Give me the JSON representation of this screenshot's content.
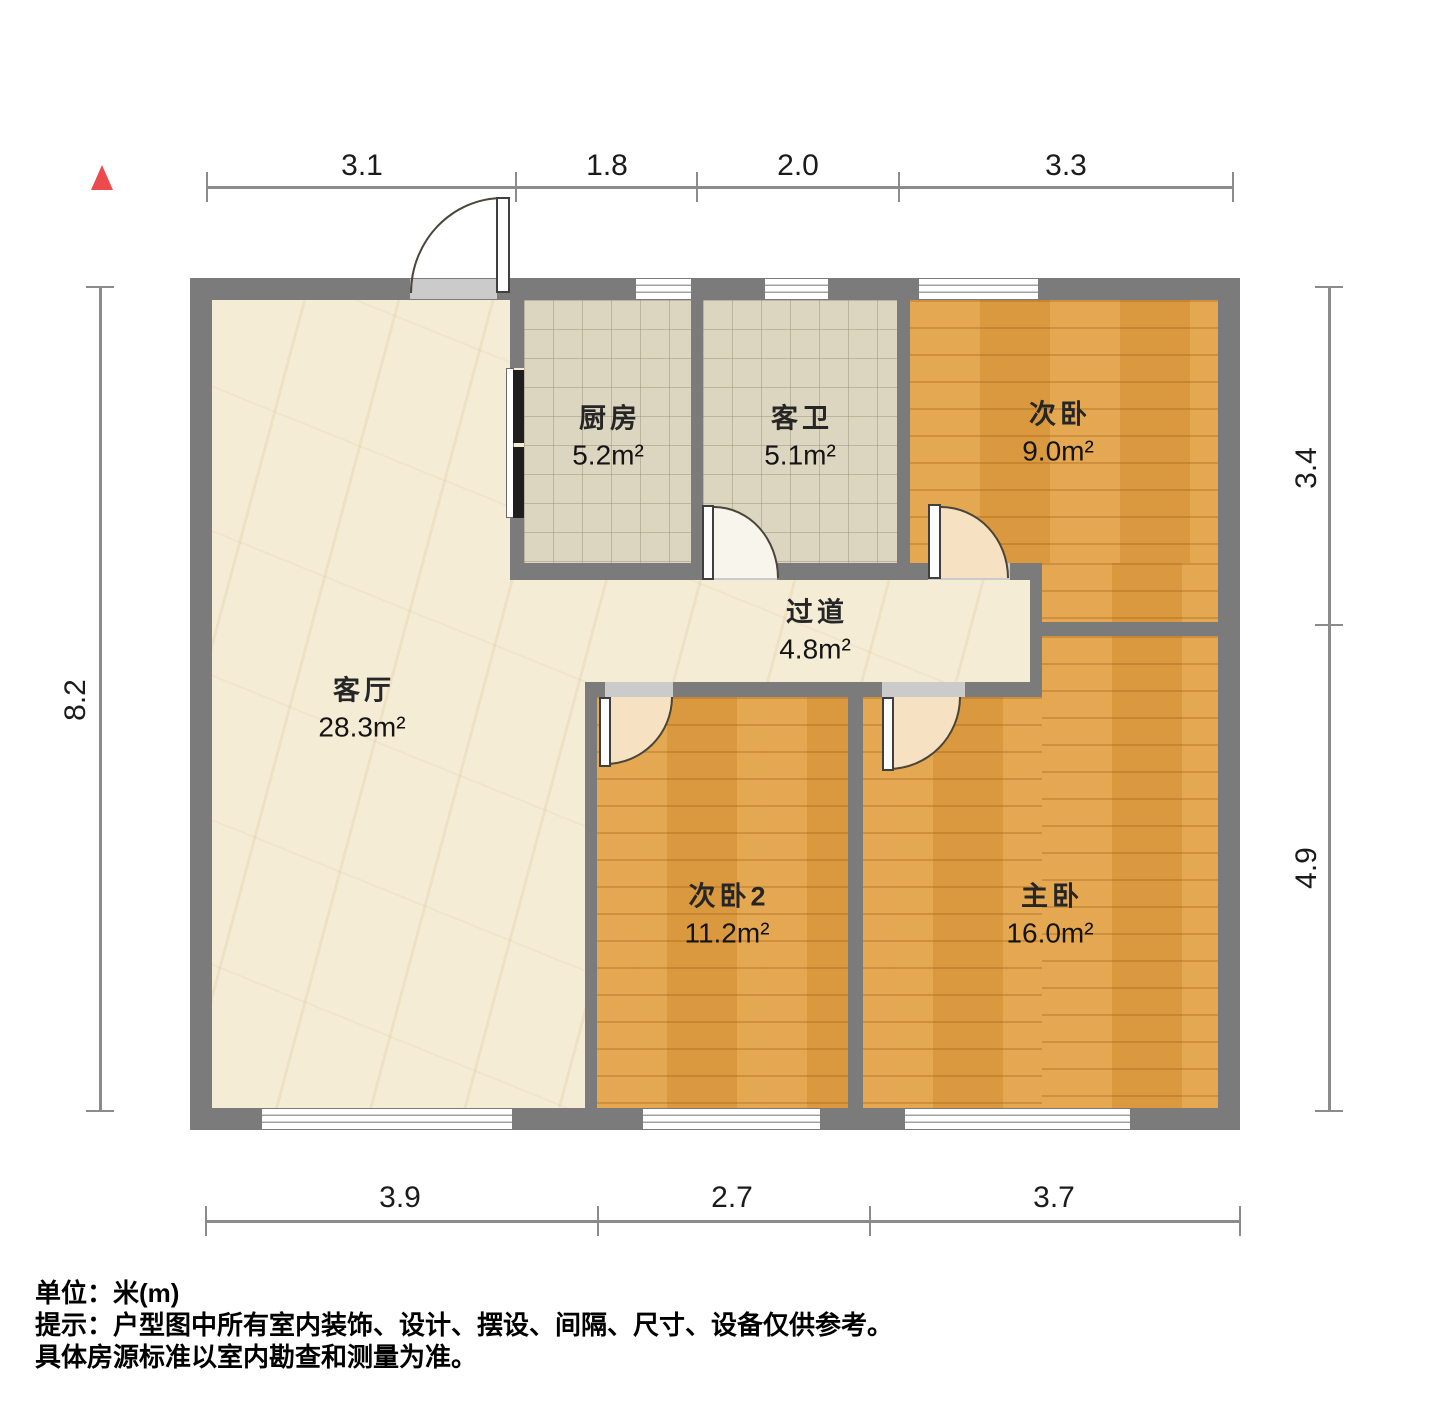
{
  "plan": {
    "rooms": [
      {
        "name": "厨房",
        "area": "5.2m²"
      },
      {
        "name": "客卫",
        "area": "5.1m²"
      },
      {
        "name": "次卧",
        "area": "9.0m²"
      },
      {
        "name": "过道",
        "area": "4.8m²"
      },
      {
        "name": "客厅",
        "area": "28.3m²"
      },
      {
        "name": "次卧2",
        "area": "11.2m²"
      },
      {
        "name": "主卧",
        "area": "16.0m²"
      }
    ],
    "dimensions_top": [
      "3.1",
      "1.8",
      "2.0",
      "3.3"
    ],
    "dimensions_bottom": [
      "3.9",
      "2.7",
      "3.7"
    ],
    "dimension_left": "8.2",
    "dimensions_right": [
      "3.4",
      "4.9"
    ]
  },
  "footer": {
    "unit": "单位：米(m)",
    "note1": "提示：户型图中所有室内装饰、设计、摆设、间隔、尺寸、设备仅供参考。",
    "note2": "具体房源标准以室内勘查和测量为准。"
  },
  "icons": {
    "north_marker": "red-triangle-north"
  },
  "colors": {
    "wall": "#7b7b7b",
    "wood_floor": "#e2a144",
    "tile_floor": "#dcd6c1",
    "cream_floor": "#f5ecd6",
    "door_swing": "#f6e2c3",
    "north_marker": "#ed4a4d"
  }
}
